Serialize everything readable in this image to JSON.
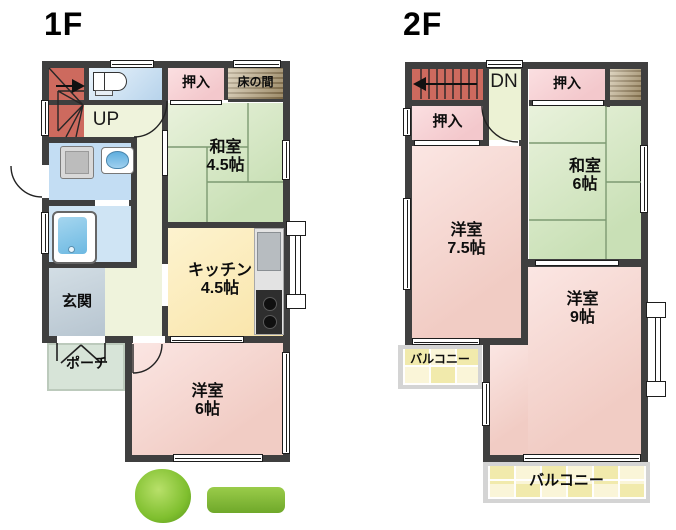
{
  "floor1": {
    "title": "1F",
    "stairs": "UP",
    "closet": "押入",
    "tokonoma": "床の間",
    "japanese_room": {
      "name": "和室",
      "size": "4.5帖"
    },
    "kitchen": {
      "name": "キッチン",
      "size": "4.5帖"
    },
    "entrance": "玄関",
    "porch": "ポーチ",
    "western_room": {
      "name": "洋室",
      "size": "6帖"
    }
  },
  "floor2": {
    "title": "2F",
    "stairs": "DN",
    "closet_top": "押入",
    "closet_left": "押入",
    "japanese_room": {
      "name": "和室",
      "size": "6帖"
    },
    "western_room_75": {
      "name": "洋室",
      "size": "7.5帖"
    },
    "western_room_9": {
      "name": "洋室",
      "size": "9帖"
    },
    "balcony_left": "バルコニー",
    "balcony_rear": "バルコニー"
  },
  "palette": {
    "wall": "#3f3f3f",
    "tatami_green": "#cfe3bd",
    "western_pink": "#f2cfc8",
    "closet_pink": "#f6ced2",
    "kitchen_yellow": "#fbe9b4",
    "stairs_red": "#cd6a5e",
    "balcony_yellow": "#f3edb8",
    "bath_blue": "#c2dcf2",
    "entrance_gray": "#c6d3da",
    "hall_cream": "#eff3dc",
    "porch_green": "#d7e4d8",
    "tokonoma_brown": "#9c8a66",
    "greenery": "#7fbf2e"
  }
}
